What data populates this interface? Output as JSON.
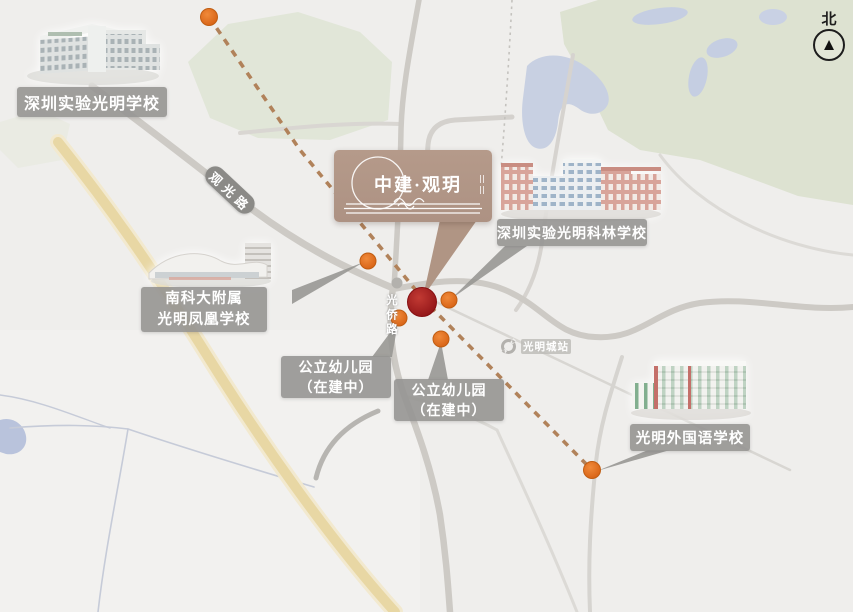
{
  "compass": {
    "north_label": "北"
  },
  "project": {
    "brand": "中建·观玥",
    "marker": "project-location"
  },
  "schools": [
    {
      "name": "深圳实验光明学校"
    },
    {
      "name_line1": "南科大附属",
      "name_line2": "光明凤凰学校"
    },
    {
      "name": "深圳实验光明科林学校"
    },
    {
      "name": "光明外国语学校"
    }
  ],
  "kindergartens": [
    {
      "line1": "公立幼儿园",
      "line2": "（在建中）"
    },
    {
      "line1": "公立幼儿园",
      "line2": "（在建中）"
    }
  ],
  "roads": {
    "guanguang": "观光路",
    "guangqiao": "光侨路"
  },
  "metro": {
    "station": "光明城站"
  },
  "colors": {
    "route_dashed": "#b1825a",
    "marker_orange": "#e06d1f",
    "project_red": "#a81e22",
    "bubble_brown": "#b09584",
    "label_gray": "#969592",
    "highway_yellow": "#e8d7a4",
    "green_area": "#dfe4d5",
    "water_blue": "#c8d0e2",
    "road_gray": "#cdcac5"
  }
}
